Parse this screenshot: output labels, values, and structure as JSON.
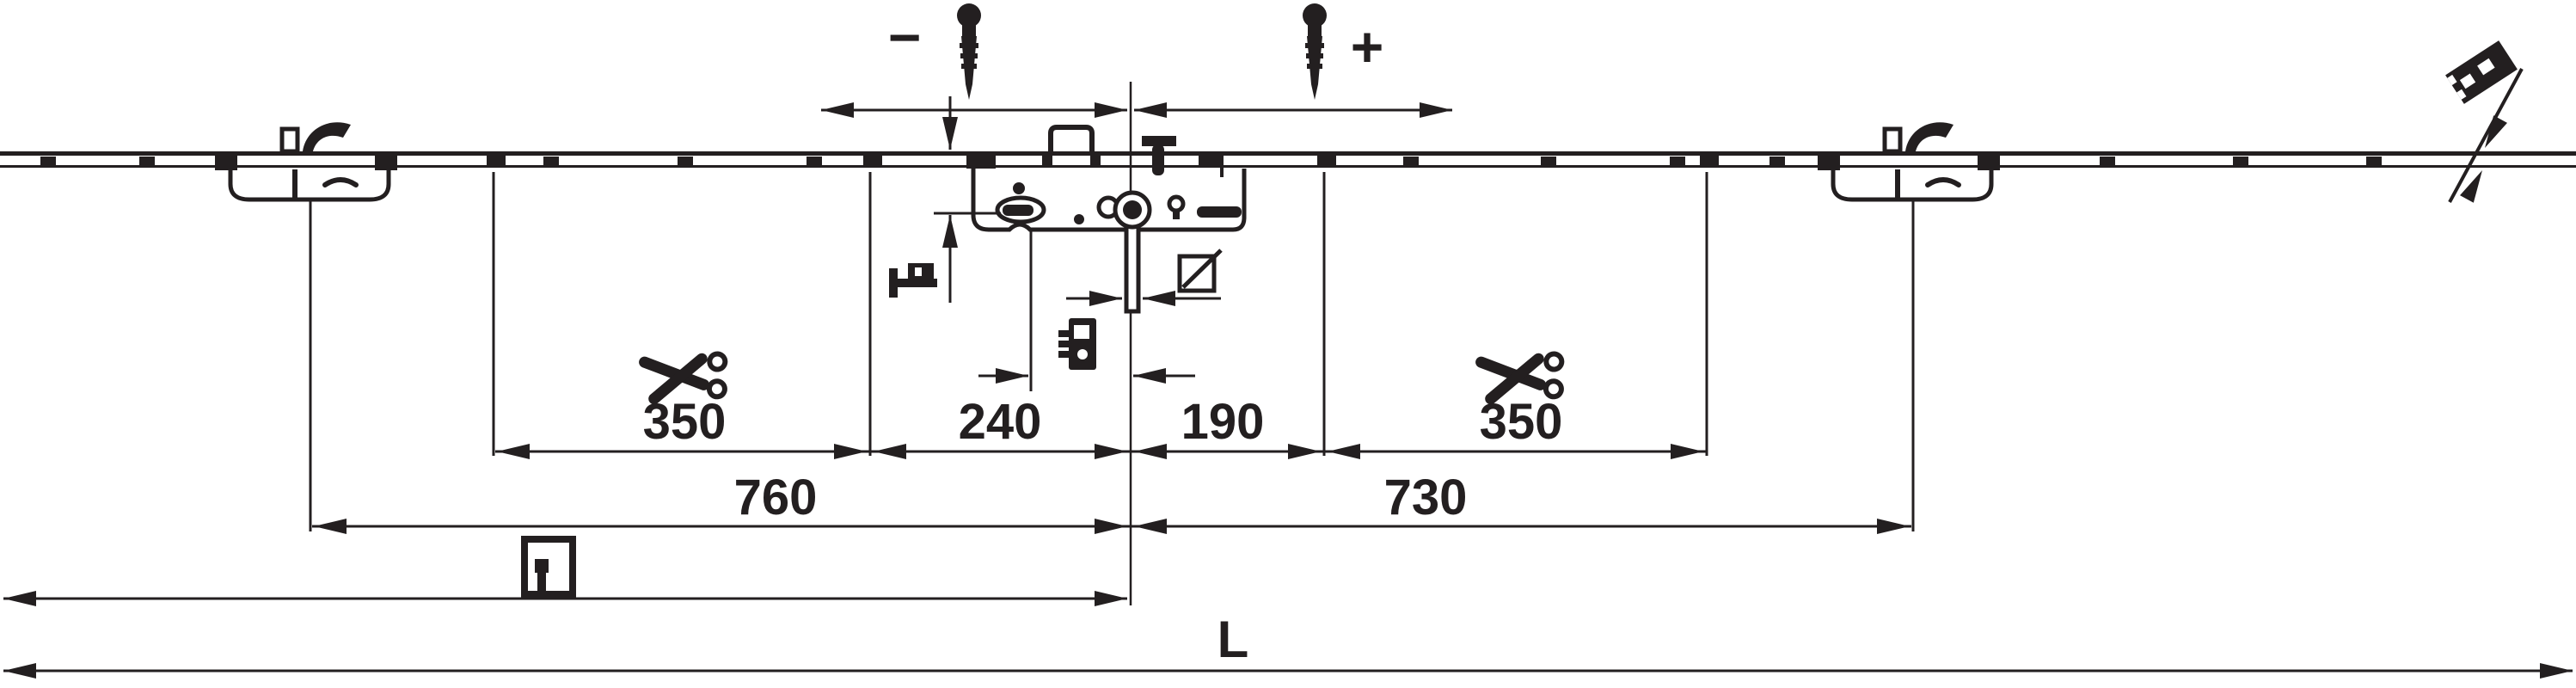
{
  "drawing": {
    "background": "#ffffff",
    "ink": "#231f20",
    "adjustment": {
      "minus": "−",
      "plus": "+"
    },
    "segment_dims": [
      {
        "label": "350"
      },
      {
        "label": "240"
      },
      {
        "label": "190"
      },
      {
        "label": "350"
      }
    ],
    "span_dims": [
      {
        "label": "760"
      },
      {
        "label": "730"
      }
    ],
    "overall_length": {
      "label": "L"
    },
    "icons": {
      "screws": "adjustment-screw",
      "scissors": "cut-to-length-scissors",
      "spindle_square": "square-spindle-symbol",
      "cylinder_plate": "lock-cylinder-fixing",
      "handle": "handle-lever-side-view",
      "door_leaf": "door-leaf-with-handle",
      "profile_section": "profile-cross-section-gauge"
    }
  }
}
